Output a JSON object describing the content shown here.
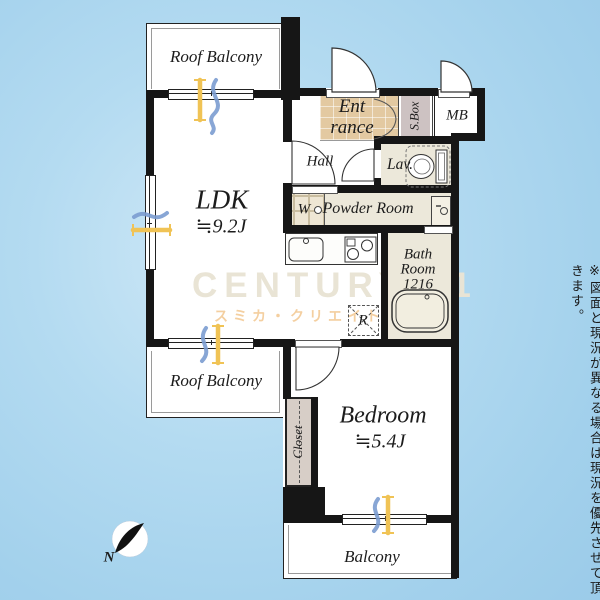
{
  "rooms": {
    "roof_balcony_top": {
      "label": "Roof Balcony"
    },
    "ldk": {
      "label": "LDK",
      "size": "≒9.2J"
    },
    "entrance": {
      "line1": "Ent",
      "line2": "rance"
    },
    "shoe_box": {
      "label": "S.Box"
    },
    "meter_box": {
      "label": "MB"
    },
    "hall": {
      "label": "Hall"
    },
    "lavatory": {
      "label": "Lav."
    },
    "powder_room": {
      "label": "Powder Room"
    },
    "washer": {
      "label": "W"
    },
    "bath_room": {
      "line1": "Bath",
      "line2": "Room",
      "line3": "1216"
    },
    "refrigerator": {
      "label": "R"
    },
    "roof_balcony_mid": {
      "label": "Roof Balcony"
    },
    "bedroom": {
      "label": "Bedroom",
      "size": "≒5.4J"
    },
    "closet": {
      "label": "Closet"
    },
    "balcony": {
      "label": "Balcony"
    }
  },
  "compass": {
    "label": "N"
  },
  "watermark": {
    "brand": "CENTURY 21",
    "company": "スミカ・クリエイト"
  },
  "disclaimer": "※図面と現況が異なる場合は現況を優先させて頂きます。",
  "colors": {
    "background_blue": "#a6d3ec",
    "wall": "#161616",
    "room_beige": "#ece8da",
    "entrance_tile": "#e3c9a1",
    "shoe_box_gray": "#cdc2c2",
    "closet_fill": "#d7cec7",
    "curtain_blue": "#7b9cd0",
    "curtain_yellow": "#f0c355",
    "watermark_gray": "#e9e4d5",
    "watermark_orange": "#f4cfa0"
  }
}
